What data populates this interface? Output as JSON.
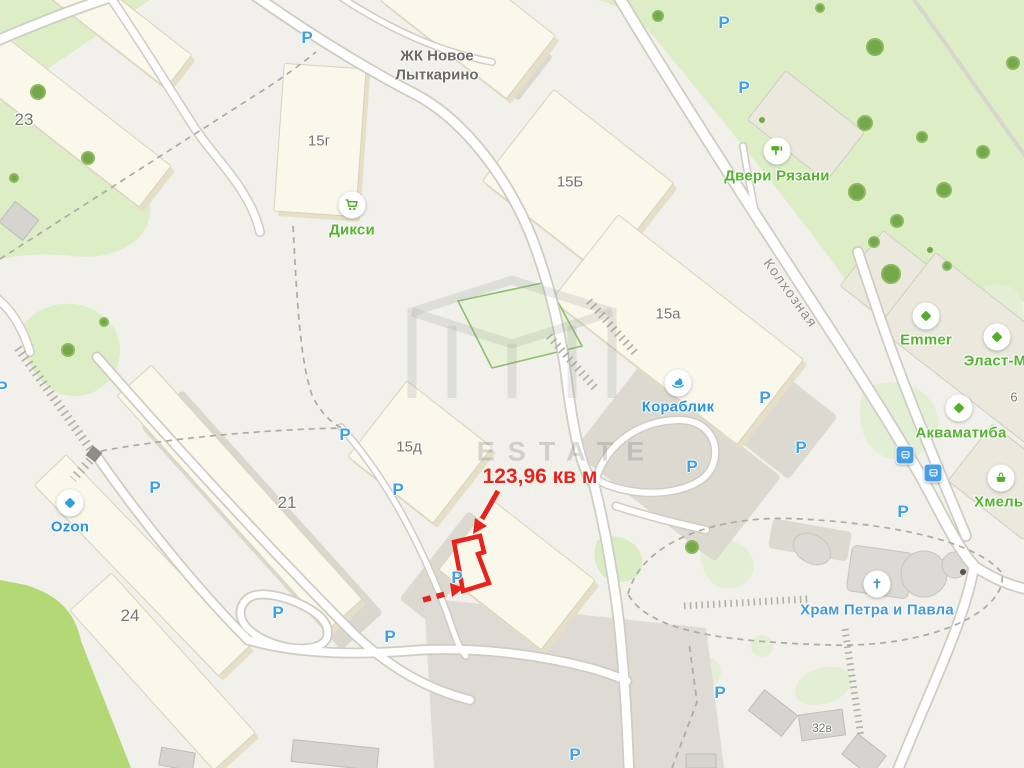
{
  "map": {
    "complex_title": "ЖК Новое\nЛыткарино",
    "street": {
      "name": "Колхозная",
      "x": 791,
      "y": 293
    },
    "watermark_text": "ESTATE",
    "annotation": {
      "text": "123,96 кв м",
      "x": 540,
      "y": 477
    },
    "parking_glyph": "P",
    "colors": {
      "poi_green": "#53ae2a",
      "poi_blue": "#2f9fe0",
      "label_green": "#55b331",
      "label_blue": "#2795dd",
      "church_blue": "#4499d6",
      "parking_blue": "#3f9fe8",
      "building_label": "#76756e",
      "annotation_red": "#e6231c"
    },
    "building_labels": [
      {
        "text": "23",
        "x": 24,
        "y": 120,
        "size": 17
      },
      {
        "text": "15г",
        "x": 319,
        "y": 141,
        "size": 15
      },
      {
        "text": "15Б",
        "x": 570,
        "y": 182,
        "size": 15
      },
      {
        "text": "15а",
        "x": 668,
        "y": 314,
        "size": 15
      },
      {
        "text": "15д",
        "x": 409,
        "y": 447,
        "size": 15
      },
      {
        "text": "21",
        "x": 287,
        "y": 503,
        "size": 17
      },
      {
        "text": "24",
        "x": 130,
        "y": 616,
        "size": 17
      },
      {
        "text": "6",
        "x": 1014,
        "y": 397,
        "size": 13
      },
      {
        "text": "32в",
        "x": 822,
        "y": 728,
        "size": 12
      }
    ],
    "pois": [
      {
        "label": "Дикси",
        "icon": "cart-icon",
        "type": "green",
        "ix": 352,
        "iy": 205,
        "lx": 352,
        "ly": 230
      },
      {
        "label": "Двери Рязани",
        "icon": "roller-icon",
        "type": "green",
        "ix": 777,
        "iy": 151,
        "lx": 777,
        "ly": 176
      },
      {
        "label": "Кораблик",
        "icon": "horse-icon",
        "type": "blue",
        "ix": 678,
        "iy": 383,
        "lx": 678,
        "ly": 407
      },
      {
        "label": "Ozon",
        "icon": "diamond-icon",
        "type": "blue",
        "ix": 70,
        "iy": 503,
        "lx": 70,
        "ly": 527
      },
      {
        "label": "Emmer",
        "icon": "diamond-icon",
        "type": "green",
        "ix": 926,
        "iy": 316,
        "lx": 926,
        "ly": 340
      },
      {
        "label": "Эласт-М",
        "icon": "diamond-icon",
        "type": "green",
        "ix": 997,
        "iy": 337,
        "lx": 995,
        "ly": 361
      },
      {
        "label": "Акваматиба",
        "icon": "diamond-icon",
        "type": "green",
        "ix": 959,
        "iy": 408,
        "lx": 961,
        "ly": 433
      },
      {
        "label": "Хмель Х",
        "icon": "basket-icon",
        "type": "green",
        "ix": 1001,
        "iy": 478,
        "lx": 1006,
        "ly": 502
      },
      {
        "label": "Храм Петра и Павла",
        "icon": "cross-icon",
        "type": "church",
        "ix": 877,
        "iy": 584,
        "lx": 877,
        "ly": 610
      }
    ],
    "parking_markers": [
      {
        "x": 307,
        "y": 38
      },
      {
        "x": 724,
        "y": 23
      },
      {
        "x": 744,
        "y": 88
      },
      {
        "x": 2,
        "y": 388
      },
      {
        "x": 345,
        "y": 435
      },
      {
        "x": 398,
        "y": 490
      },
      {
        "x": 155,
        "y": 488
      },
      {
        "x": 457,
        "y": 578
      },
      {
        "x": 278,
        "y": 613
      },
      {
        "x": 390,
        "y": 637
      },
      {
        "x": 692,
        "y": 467
      },
      {
        "x": 765,
        "y": 398
      },
      {
        "x": 801,
        "y": 448
      },
      {
        "x": 903,
        "y": 512
      },
      {
        "x": 720,
        "y": 693
      },
      {
        "x": 575,
        "y": 755
      }
    ],
    "bus_stops": [
      {
        "x": 905,
        "y": 455
      },
      {
        "x": 933,
        "y": 473
      }
    ]
  }
}
